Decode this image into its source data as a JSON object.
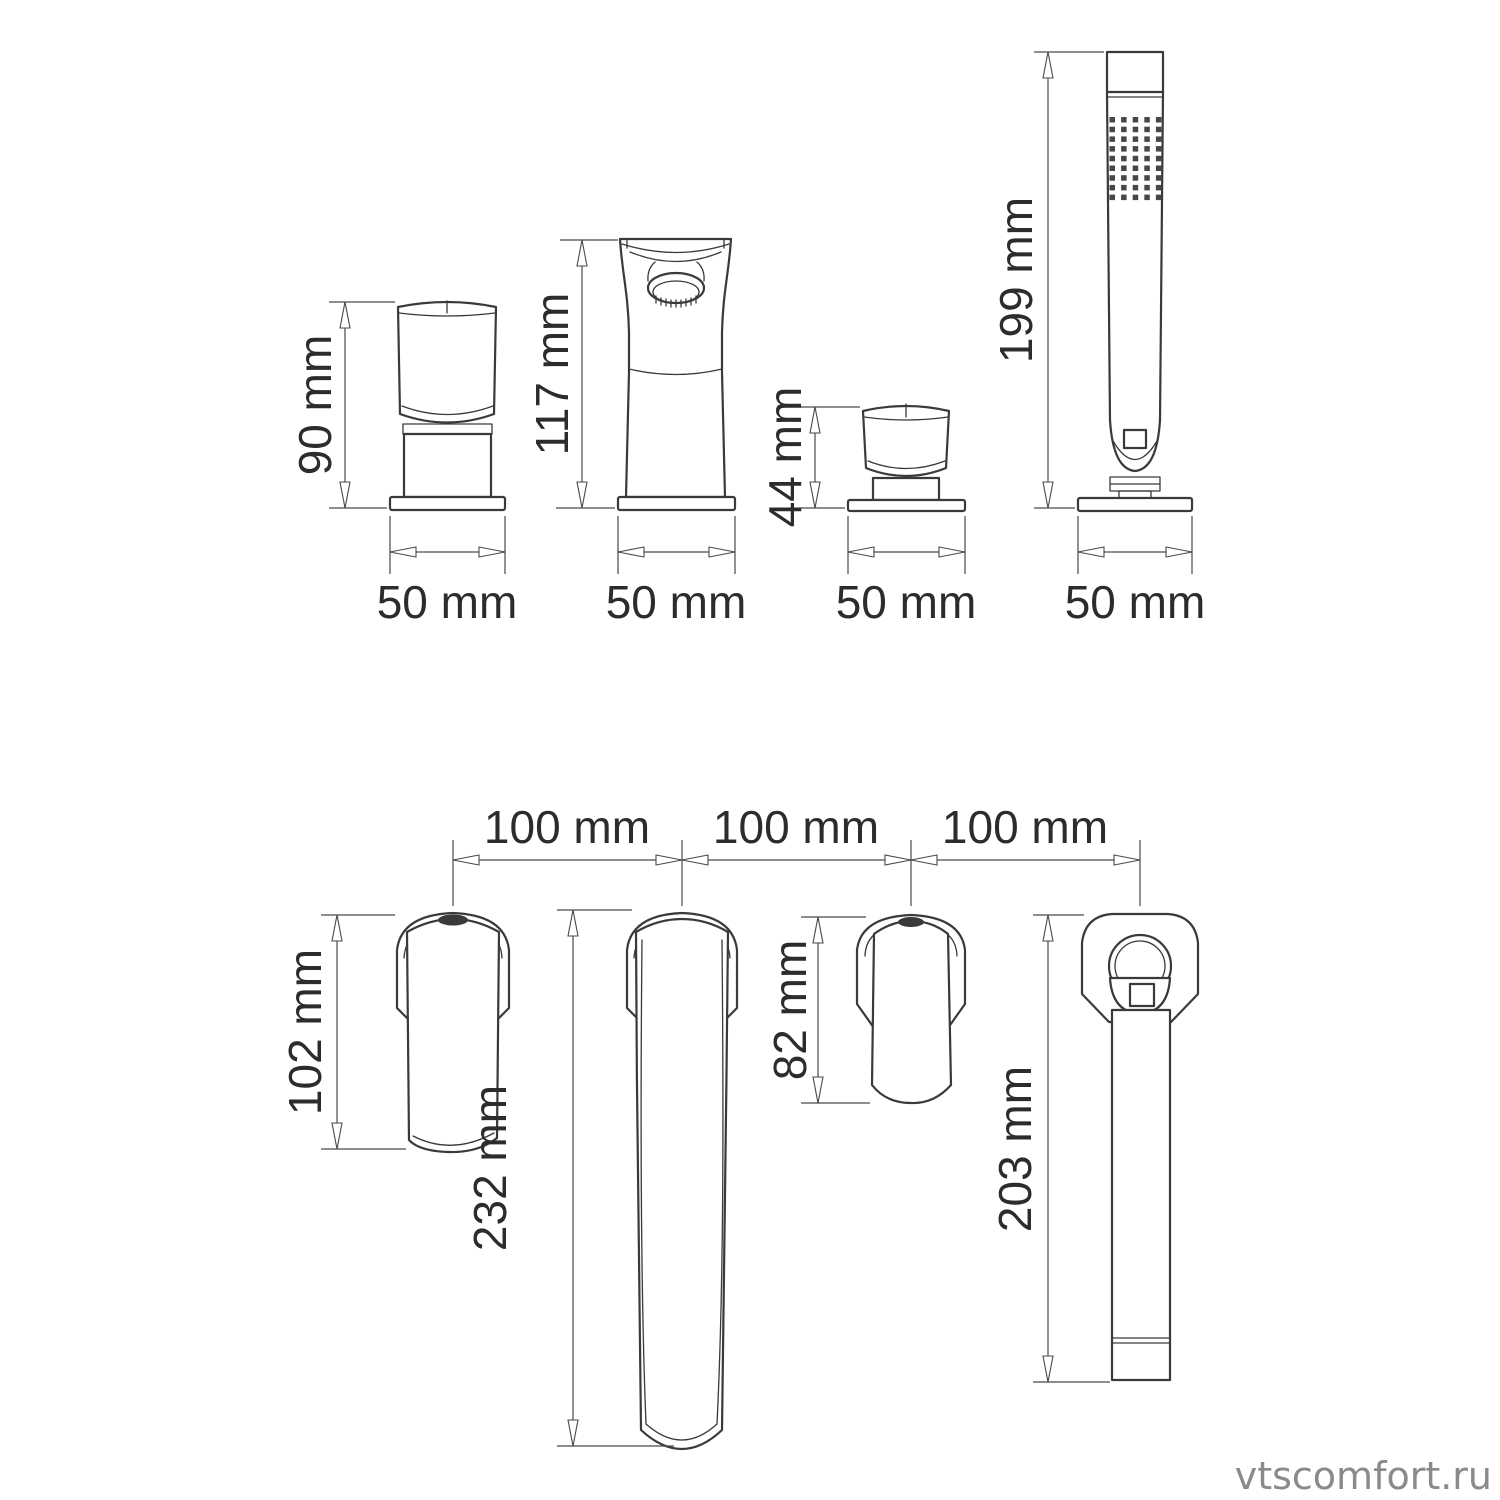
{
  "watermark": "vtscomfort.ru",
  "colors": {
    "line": "#3a3a3a",
    "dimension": "#4a4a4a",
    "text": "#2c2c2c",
    "watermark": "#8a8a8a",
    "background": "#ffffff"
  },
  "front_views": {
    "hot_handle": {
      "height": "90 mm",
      "width": "50 mm"
    },
    "spout": {
      "height": "117 mm",
      "width": "50 mm"
    },
    "cold_handle": {
      "height": "44 mm",
      "width": "50 mm"
    },
    "handshower": {
      "height": "199 mm",
      "width": "50 mm"
    }
  },
  "hole_spacing": {
    "first": "100 mm",
    "second": "100 mm",
    "third": "100 mm"
  },
  "top_views": {
    "hot_handle": {
      "length": "102 mm"
    },
    "spout": {
      "length": "232 mm"
    },
    "cold_handle": {
      "length": "82 mm"
    },
    "handshower": {
      "length": "203 mm"
    }
  }
}
